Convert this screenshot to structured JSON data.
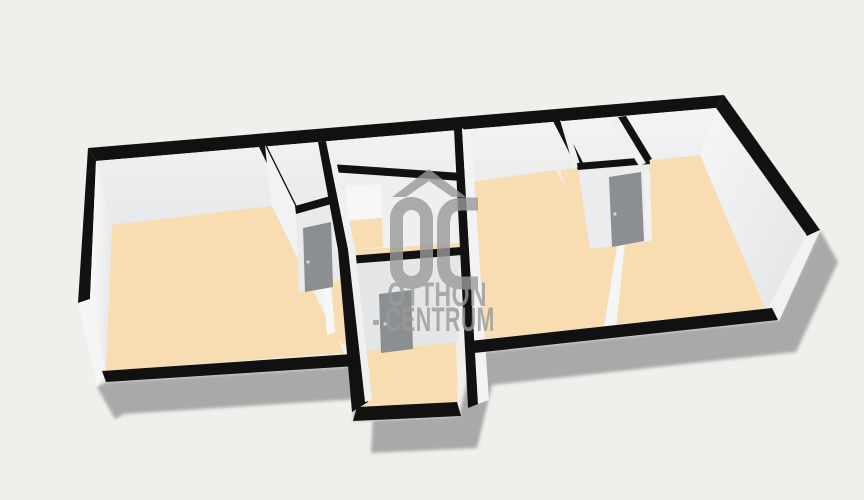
{
  "watermark": {
    "logo_text": "OC",
    "line1": "OTTHON",
    "line2": "CENTRUM"
  },
  "colors": {
    "background": "#f0efeb",
    "wall_top": "#111111",
    "wall_face": "#f0f1f3",
    "floor": "#f9ddb2",
    "door": "#8c8f91",
    "door_frame": "#f1f1f1",
    "shadow": "#a9a9a9",
    "watermark": "#9a9a9a"
  }
}
